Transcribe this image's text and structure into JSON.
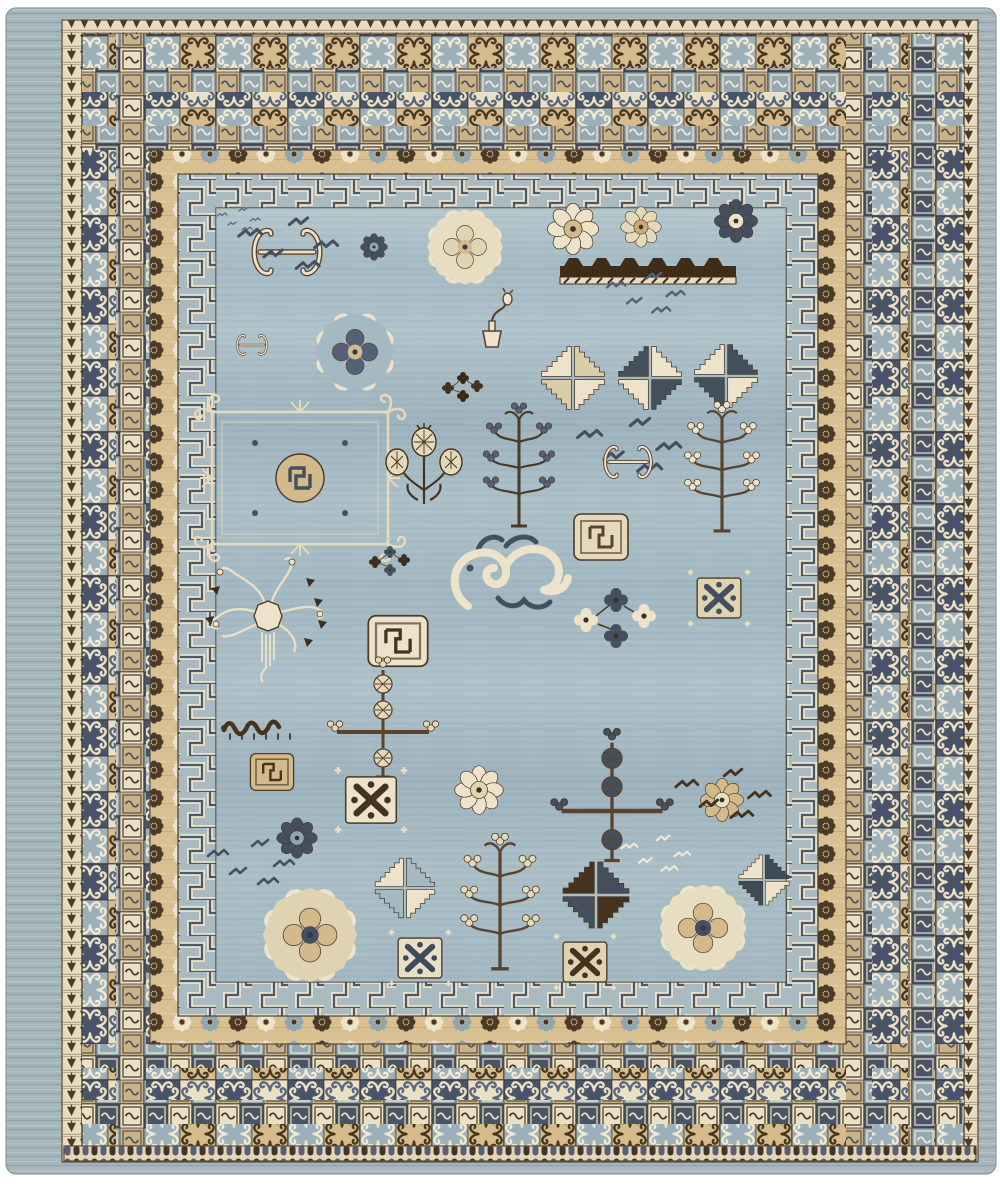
{
  "image": {
    "subject": "Hand-knotted Khotan-style wool rug with light blue field and layered geometric borders",
    "background": "#ffffff"
  },
  "palette": {
    "field_blue": "#a7bbc4",
    "field_streak_dark": "#98aeb9",
    "field_streak_light": "#b4c6cc",
    "selvage_blue": "#a3b3b9",
    "cream": "#ece3ca",
    "ivory": "#f0e9d6",
    "sand_band": "#d8c093",
    "tan": "#d3ba8c",
    "dark_brown": "#46331f",
    "navy_slate": "#475164",
    "mid_slate": "#55607a",
    "light_slate_blue": "#9cb0ba"
  },
  "rug": {
    "rings": [
      {
        "name": "selvage-edge",
        "x": 6,
        "y": 8,
        "w": 990,
        "h": 1166,
        "rx": 10,
        "p": "selvage",
        "stroke": "#8a9aa0"
      },
      {
        "name": "comb-band",
        "x": 62,
        "y": 20,
        "w": 916,
        "h": 1142,
        "p": "saw",
        "stroke": "#5f4c36"
      },
      {
        "name": "outer-scroll-tile-border",
        "x": 82,
        "y": 34,
        "w": 882,
        "h": 1120,
        "p": "big",
        "stroke": "#3c2f20"
      },
      {
        "name": "small-tile-column-left",
        "x": 116,
        "y": 34,
        "w": 30,
        "h": 1120,
        "p": "small"
      },
      {
        "name": "small-tile-column-right-a",
        "x": 846,
        "y": 34,
        "w": 26,
        "h": 1120,
        "p": "small"
      },
      {
        "name": "small-tile-column-right-b",
        "x": 908,
        "y": 34,
        "w": 26,
        "h": 1120,
        "p": "small"
      },
      {
        "name": "small-tile-row-top-a",
        "x": 82,
        "y": 68,
        "w": 882,
        "h": 24,
        "p": "small"
      },
      {
        "name": "small-tile-row-top-b",
        "x": 82,
        "y": 126,
        "w": 882,
        "h": 24,
        "p": "small"
      },
      {
        "name": "small-tile-row-bottom-a",
        "x": 82,
        "y": 1044,
        "w": 882,
        "h": 24,
        "p": "small"
      },
      {
        "name": "small-tile-row-bottom-b",
        "x": 82,
        "y": 1100,
        "w": 882,
        "h": 24,
        "p": "small"
      },
      {
        "name": "rosette-band",
        "x": 150,
        "y": 150,
        "w": 696,
        "h": 894,
        "p": "rosettes",
        "stroke": "#5f4c36"
      },
      {
        "name": "fret-border",
        "x": 178,
        "y": 174,
        "w": 640,
        "h": 842,
        "p": "fret",
        "stroke": "#4a3f2e"
      },
      {
        "name": "field",
        "x": 216,
        "y": 208,
        "w": 570,
        "h": 774,
        "p": "field",
        "stroke": "#4a3f2e"
      },
      {
        "name": "field-abrash",
        "x": 216,
        "y": 208,
        "w": 570,
        "h": 774,
        "p": "abrash",
        "opacity": 0.5
      },
      {
        "name": "bead-edge-bottom",
        "x": 64,
        "y": 1146,
        "w": 912,
        "h": 15,
        "p": "beads",
        "stroke": "#5f4c36"
      }
    ],
    "motifs": [
      {
        "t": "birdmarks",
        "x": 238,
        "y": 222,
        "s": 0.5,
        "c": [
          "#5b6b7d"
        ]
      },
      {
        "t": "hbracket",
        "x": 287,
        "y": 252,
        "s": 1,
        "c": [
          "#ece3ca",
          "#5a4430"
        ]
      },
      {
        "t": "birdmarks",
        "x": 287,
        "y": 250,
        "s": 1.15,
        "c": [
          "#45505f"
        ]
      },
      {
        "t": "rosette",
        "x": 374,
        "y": 247,
        "s": 0.5,
        "c": [
          "#45505f",
          "#8fa6b3"
        ]
      },
      {
        "t": "scallop",
        "x": 465,
        "y": 247,
        "s": 1.0,
        "c": [
          "#ece3ca",
          "#e7ddc1",
          "#e0d4b2",
          "#d3ba8c"
        ]
      },
      {
        "t": "rosette",
        "x": 573,
        "y": 229,
        "s": 0.95,
        "c": [
          "#ece3ca",
          "#d3ba8c"
        ]
      },
      {
        "t": "rosette",
        "x": 641,
        "y": 227,
        "s": 0.75,
        "c": [
          "#e4d9bb",
          "#c8ab79"
        ]
      },
      {
        "t": "rosette",
        "x": 736,
        "y": 221,
        "s": 0.8,
        "c": [
          "#45505f",
          "#ece3ca"
        ]
      },
      {
        "t": "crenbar",
        "x": 648,
        "y": 268,
        "s": 1,
        "c": [
          "#3f2d1a"
        ]
      },
      {
        "t": "birdmarks",
        "x": 645,
        "y": 298,
        "s": 0.9,
        "c": [
          "#55607a"
        ]
      },
      {
        "t": "scallop",
        "x": 355,
        "y": 352,
        "s": 1.05,
        "c": [
          "#ece3ca",
          "#a4b9c2",
          "#55607a",
          "#d3ba8c"
        ]
      },
      {
        "t": "hbracket",
        "x": 252,
        "y": 345,
        "s": 0.45,
        "c": [
          "#ece3ca",
          "#5a4430"
        ]
      },
      {
        "t": "vase",
        "x": 492,
        "y": 325,
        "s": 1,
        "c": [
          "#5a4430",
          "#ece3ca"
        ]
      },
      {
        "t": "blossom",
        "x": 463,
        "y": 386,
        "s": 0.5,
        "c": [
          "#46331f",
          "#3a2817"
        ]
      },
      {
        "t": "pinwheel",
        "x": 573,
        "y": 378,
        "s": 1,
        "c": [
          "#ece3ca",
          "#d9cdaa"
        ]
      },
      {
        "t": "pinwheel",
        "x": 650,
        "y": 378,
        "s": 1,
        "c": [
          "#45505f",
          "#ece3ca"
        ]
      },
      {
        "t": "pinwheel",
        "x": 726,
        "y": 376,
        "s": 1,
        "c": [
          "#ece3ca",
          "#45505f"
        ]
      },
      {
        "t": "lattice",
        "x": 300,
        "y": 478,
        "s": 1,
        "c": [
          "#e4d9bb",
          "#d3ba8c",
          "#45505f"
        ]
      },
      {
        "t": "pomcluster",
        "x": 424,
        "y": 470,
        "s": 1,
        "c": [
          "#46331f",
          "#e4d9bb"
        ]
      },
      {
        "t": "pomtree",
        "x": 519,
        "y": 468,
        "s": 1,
        "c": [
          "#4a3a26",
          "#55607a"
        ]
      },
      {
        "t": "birdmarks",
        "x": 628,
        "y": 452,
        "s": 1.2,
        "c": [
          "#45505f"
        ]
      },
      {
        "t": "hbracket",
        "x": 628,
        "y": 462,
        "s": 0.7,
        "c": [
          "#ece3ca",
          "#5a4430"
        ]
      },
      {
        "t": "pomtree",
        "x": 722,
        "y": 470,
        "s": 1.05,
        "c": [
          "#5a4430",
          "#ece3ca"
        ]
      },
      {
        "t": "blossom",
        "x": 390,
        "y": 560,
        "s": 0.5,
        "c": [
          "#3a2f22",
          "#45505f"
        ]
      },
      {
        "t": "dragon",
        "x": 508,
        "y": 572,
        "s": 1,
        "c": [
          "#ece3ca",
          "#45505f"
        ]
      },
      {
        "t": "fretcoin",
        "x": 601,
        "y": 537,
        "s": 1,
        "c": [
          "#e4d9bb",
          "#5a4430"
        ]
      },
      {
        "t": "blossom",
        "x": 616,
        "y": 616,
        "s": 1,
        "c": [
          "#ece3ca",
          "#45505f"
        ]
      },
      {
        "t": "xtile",
        "x": 719,
        "y": 598,
        "s": 0.95,
        "c": [
          "#dfd3b2",
          "#45505f"
        ]
      },
      {
        "t": "spidertree",
        "x": 268,
        "y": 612,
        "s": 1,
        "c": [
          "#e8dfc5",
          "#ece3ca"
        ]
      },
      {
        "t": "fretcoin",
        "x": 398,
        "y": 641,
        "s": 1.1,
        "c": [
          "#ece3ca",
          "#46331f"
        ]
      },
      {
        "t": "caterpillar",
        "x": 262,
        "y": 726,
        "s": 1,
        "c": [
          "#46331f"
        ]
      },
      {
        "t": "pole",
        "x": 383,
        "y": 722,
        "s": 1,
        "c": [
          "#5a4430",
          "#e4d9bb"
        ]
      },
      {
        "t": "fretcoin",
        "x": 272,
        "y": 772,
        "s": 0.8,
        "c": [
          "#d3ba8c",
          "#46331f"
        ]
      },
      {
        "t": "xtile",
        "x": 371,
        "y": 800,
        "s": 1.1,
        "c": [
          "#ece3ca",
          "#46331f"
        ]
      },
      {
        "t": "rosette",
        "x": 297,
        "y": 838,
        "s": 0.75,
        "c": [
          "#45505f",
          "#8fa6b3"
        ]
      },
      {
        "t": "rosette",
        "x": 479,
        "y": 790,
        "s": 0.9,
        "c": [
          "#ece3ca",
          "#e0d4b2"
        ]
      },
      {
        "t": "pole",
        "x": 612,
        "y": 800,
        "s": 1.1,
        "c": [
          "#5a4430",
          "#45505f"
        ]
      },
      {
        "t": "rosette",
        "x": 722,
        "y": 800,
        "s": 0.8,
        "c": [
          "#d3ba8c",
          "#e8dfc5"
        ]
      },
      {
        "t": "birdmarks",
        "x": 722,
        "y": 800,
        "s": 1.1,
        "c": [
          "#46331f"
        ]
      },
      {
        "t": "birdmarks",
        "x": 250,
        "y": 868,
        "s": 1.0,
        "c": [
          "#45505f"
        ]
      },
      {
        "t": "birdmarks",
        "x": 655,
        "y": 858,
        "s": 0.8,
        "c": [
          "#f0e9d6"
        ]
      },
      {
        "t": "scallop",
        "x": 310,
        "y": 935,
        "s": 1.25,
        "c": [
          "#ece3ca",
          "#dfd3b2",
          "#d3ba8c",
          "#45505f"
        ]
      },
      {
        "t": "pinwheel",
        "x": 405,
        "y": 888,
        "s": 0.95,
        "c": [
          "#ece3ca",
          "#a4b9c2"
        ]
      },
      {
        "t": "pinwheel",
        "x": 596,
        "y": 895,
        "s": 1.05,
        "c": [
          "#46331f",
          "#45505f"
        ]
      },
      {
        "t": "pomtree",
        "x": 500,
        "y": 905,
        "s": 1.1,
        "c": [
          "#5a4430",
          "#e4d9bb"
        ]
      },
      {
        "t": "xtile",
        "x": 420,
        "y": 958,
        "s": 0.95,
        "c": [
          "#e8dfc5",
          "#3f4a5a"
        ]
      },
      {
        "t": "xtile",
        "x": 585,
        "y": 962,
        "s": 0.95,
        "c": [
          "#dfd3b2",
          "#46331f"
        ]
      },
      {
        "t": "scallop",
        "x": 703,
        "y": 928,
        "s": 1.15,
        "c": [
          "#ece3ca",
          "#e7ddc1",
          "#d3ba8c",
          "#45505f"
        ]
      },
      {
        "t": "pinwheel",
        "x": 764,
        "y": 880,
        "s": 0.8,
        "c": [
          "#ece3ca",
          "#3f4a5a"
        ]
      }
    ]
  }
}
